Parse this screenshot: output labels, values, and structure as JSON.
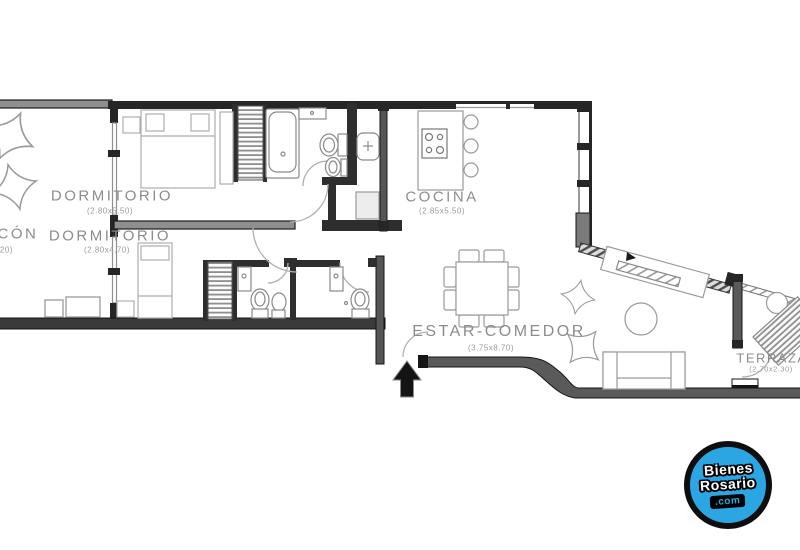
{
  "plan": {
    "rooms": [
      {
        "name": "dormitorio-1",
        "label": "DORMITORIO",
        "dims": "(2.80x5.50)"
      },
      {
        "name": "dormitorio-2",
        "label": "DORMITORIO",
        "dims": "(2.80x4.70)"
      },
      {
        "name": "balcon",
        "label": "BALCÓN",
        "dims": "(1.60x5.20)"
      },
      {
        "name": "cocina",
        "label": "COCINA",
        "dims": "(2.85x5.50)"
      },
      {
        "name": "estar-comedor",
        "label": "ESTAR-COMEDOR",
        "dims": "(3.75x8.70)"
      },
      {
        "name": "terraza",
        "label": "TERRAZA",
        "dims": "(2.70x2.30)"
      }
    ]
  },
  "watermark": {
    "line1": "Bienes",
    "line2": "Rosario",
    "line3": ".com",
    "circle_color": "#2BA6E3",
    "text_color": "#ffffff"
  },
  "colors": {
    "wall_dark": "#2e2e2e",
    "wall_gray": "#8f8f8f",
    "furniture_line": "#9a9a9a",
    "label_text": "#8c8c8c"
  }
}
